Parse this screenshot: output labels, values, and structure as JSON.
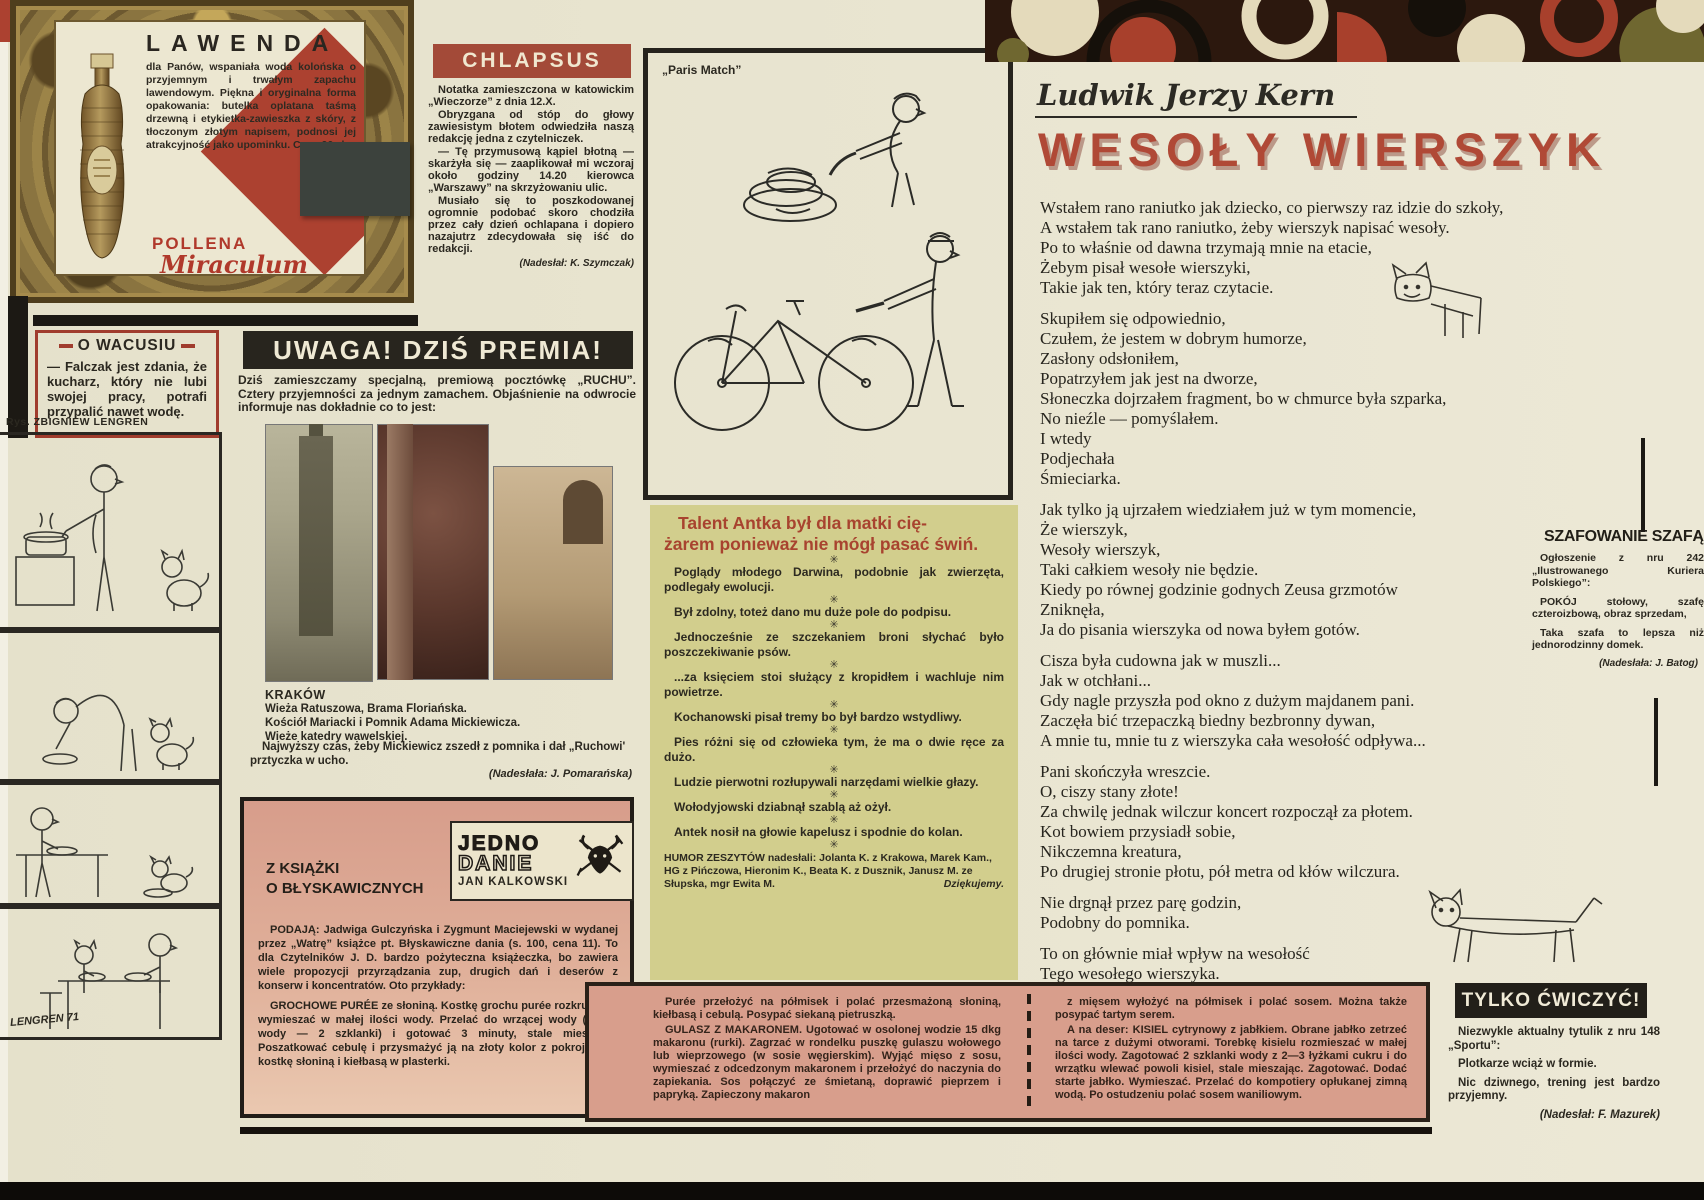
{
  "lawenda": {
    "title": "LAWENDA",
    "body": "dla Panów, wspaniała woda kolońska o przyjemnym i trwałym zapachu lawendowym. Piękna i oryginalna forma opakowania: butelka oplatana taśmą drzewną i etykietka-zawieszka z skóry, z tłoczonym złotym napisem, podnosi jej atrakcyjność jako upominku. Cena 90 zł.",
    "code": "K—30",
    "brand": "POLLENA",
    "brand_script": "Miraculum"
  },
  "chlapsus": {
    "title": "CHLAPSUS",
    "paragraphs": [
      "Notatka zamieszczona w katowickim „Wieczorze” z dnia 12.X.",
      "Obryzgana od stóp do głowy zawiesistym błotem odwiedziła naszą redakcję jedna z czytelniczek.",
      "— Tę przymusową kąpiel błotną — skarżyła się — zaaplikował mi wczoraj około godziny 14.20 kierowca „Warszawy” na skrzyżowaniu ulic.",
      "Musiało się to poszkodowanej ogromnie podobać skoro chodziła przez cały dzień ochlapana i dopiero nazajutrz zdecydowała się iść do redakcji."
    ],
    "credit": "(Nadesłał: K. Szymczak)"
  },
  "wacusiu": {
    "title": "O WACUSIU",
    "text": "— Falczak jest zdania, że kucharz, który nie lubi swojej pracy, potrafi przypalić nawet wodę."
  },
  "lengren": {
    "caption": "Rys. ZBIGNIEW LENGREN",
    "signature": "LENGREN 71"
  },
  "uwaga": {
    "title": "UWAGA! DZIŚ PREMIA!",
    "intro": "Dziś zamieszczamy specjalną, premiową pocztówkę „RUCHU”. Cztery przyjemności za jednym zamachem. Objaśnienie na odwrocie informuje nas dokładnie co to jest:",
    "city": "KRAKÓW",
    "caption_lines": [
      "Wieża Ratuszowa, Brama Floriańska.",
      "Kościół Mariacki i Pomnik Adama Mickiewicza.",
      "Wieże katedry wawelskiej."
    ],
    "note": "Najwyższy czas, żeby Mickiewicz zszedł z pomnika i dał „Ruchowi' prztyczka w ucho.",
    "credit": "(Nadesłała: J. Pomarańska)"
  },
  "paris_match": {
    "label": "„Paris Match”"
  },
  "talent": {
    "title": "Talent Antka był dla matki cię-\nżarem ponieważ nie mógł pasać świń.",
    "separator": "✳",
    "items": [
      "Poglądy młodego Darwina, podobnie jak zwierzęta, podlegały ewolucji.",
      "Był zdolny, toteż dano mu duże pole do podpisu.",
      "Jednocześnie ze szczekaniem broni słychać było poszczekiwanie psów.",
      "...za księciem stoi służący z kropidłem i wachluje nim powietrze.",
      "Kochanowski pisał tremy bo był bardzo wstydliwy.",
      "Pies różni się od człowieka tym, że ma o dwie ręce za dużo.",
      "Ludzie pierwotni rozłupywali narzędami wielkie głazy.",
      "Wołodyjowski dziabnął szablą aż ożył.",
      "Antek nosił na głowie kapelusz i spodnie do kolan."
    ],
    "footer": "HUMOR ZESZYTÓW nadesłali: Jolanta K. z Krakowa, Marek Kam., HG z Pińczowa, Hieronim K., Beata K. z Dusznik, Janusz M. ze Słupska, mgr Ewita M.",
    "thanks": "Dziękujemy."
  },
  "kern": {
    "author": "Ludwik Jerzy Kern",
    "title": "WESOŁY WIERSZYK",
    "stanzas": [
      [
        "Wstałem rano raniutko jak dziecko, co pierwszy raz idzie do szkoły,",
        "A wstałem tak rano raniutko, żeby wierszyk napisać wesoły.",
        "Po to właśnie od dawna trzymają mnie na etacie,",
        "Żebym pisał wesołe wierszyki,",
        "Takie jak ten, który teraz czytacie."
      ],
      [
        "Skupiłem się odpowiednio,",
        "Czułem, że jestem w dobrym humorze,",
        "Zasłony odsłoniłem,",
        "Popatrzyłem jak jest na dworze,",
        "Słoneczka dojrzałem fragment, bo w chmurce była szparka,",
        "No nieźle — pomyślałem.",
        "I wtedy",
        "Podjechała",
        "Śmieciarka."
      ],
      [
        "Jak tylko ją ujrzałem wiedziałem już w tym momencie,",
        "Że wierszyk,",
        "Wesoły wierszyk,",
        "Taki całkiem wesoły nie będzie.",
        "Kiedy po równej godzinie godnych Zeusa grzmotów",
        "Zniknęła,",
        "Ja do pisania wierszyka od nowa byłem gotów."
      ],
      [
        "Cisza była cudowna jak w muszli...",
        "Jak w otchłani...",
        "Gdy nagle przyszła pod okno z dużym majdanem pani.",
        "Zaczęła bić trzepaczką biedny bezbronny dywan,",
        "A mnie tu, mnie tu z wierszyka cała wesołość odpływa..."
      ],
      [
        "Pani skończyła wreszcie.",
        "O, ciszy stany złote!",
        "Za chwilę jednak wilczur koncert rozpoczął za płotem.",
        "Kot bowiem przysiadł sobie,",
        "Nikczemna kreatura,",
        "Po drugiej stronie płotu, pół metra od kłów wilczura."
      ],
      [
        "Nie drgnął przez parę godzin,",
        "Podobny do pomnika."
      ],
      [
        "To on głównie miał wpływ na wesołość",
        "Tego wesołego wierszyka."
      ]
    ]
  },
  "szafowanie": {
    "title": "SZAFOWANIE SZAFĄ",
    "p1": "Ogłoszenie z nru 242 „Ilustrowanego Kuriera Polskiego”:",
    "p2": "POKÓJ stołowy, szafę czteroizbową, obraz sprzedam,",
    "p3": "Taka szafa to lepsza niż jednorodzinny domek.",
    "credit": "(Nadesłała: J. Batog)"
  },
  "tylko": {
    "title": "TYLKO ĆWICZYĆ!",
    "p1": "Niezwykle aktualny tytulik z nru 148 „Sportu”:",
    "p2": "Plotkarze wciąż w formie.",
    "p3": "Nic dziwnego, trening jest bardzo przyjemny.",
    "credit": "(Nadesłał: F. Mazurek)"
  },
  "jedno": {
    "section_title": "Z KSIĄŻKI\nO BŁYSKAWICZNYCH",
    "logo_line1": "JEDNO",
    "logo_line2": "DANIE",
    "logo_author": "JAN KALKOWSKI",
    "paragraphs": [
      {
        "lead": "PODAJĄ: ",
        "text": "Jadwiga Gulczyńska i Zygmunt Maciejewski w wydanej przez „Watrę” książce pt. Błyskawiczne dania (s. 100, cena 11). To dla Czytelników J. D. bardzo pożyteczna książeczka, bo zawiera wiele propozycji przyrządzania zup, drugich dań i deserów z konserw i koncentratów. Oto przykłady:"
      },
      {
        "lead": "GROCHOWE PURÉE ",
        "text": "ze słoniną. Kostkę grochu purée rozkruszyć i wymieszać w małej ilości wody. Przelać do wrzącej wody (razem wody — 2 szklanki) i gotować 3 minuty, stale mieszając. Poszatkować cebulę i przysmażyć ją na złoty kolor z pokrojoną w kostkę słoniną i kiełbasą w plasterki."
      }
    ]
  },
  "recipes": {
    "left": [
      {
        "lead": "",
        "text": "Purée przełożyć na półmisek i polać przesmażoną słoniną, kiełbasą i cebulą. Posypać siekaną pietruszką."
      },
      {
        "lead": "GULASZ Z MAKARONEM. ",
        "text": "Ugotować w osolonej wodzie 15 dkg makaronu (rurki). Zagrzać w rondelku puszkę gulaszu wołowego lub wieprzowego (w sosie węgierskim). Wyjąć mięso z sosu, wymieszać z odcedzonym makaronem i przełożyć do naczynia do zapiekania. Sos połączyć ze śmietaną, doprawić pieprzem i papryką. Zapieczony makaron"
      }
    ],
    "right": [
      {
        "lead": "",
        "text": "z mięsem wyłożyć na półmisek i polać sosem. Można także posypać tartym serem."
      },
      {
        "lead": "A na deser: KISIEL cytrynowy z jabłkiem. ",
        "text": "Obrane jabłko zetrzeć na tarce z dużymi otworami. Torebkę kisielu rozmieszać w małej ilości wody. Zagotować 2 szklanki wody z 2—3 łyżkami cukru i do wrzątku wlewać powoli kisiel, stale mieszając. Zagotować. Dodać starte jabłko. Wymieszać. Przelać do kompotiery opłukanej zimną wodą. Po ostudzeniu polać sosem waniliowym."
      }
    ]
  },
  "colors": {
    "accent_red": "#a8432f",
    "humor_bg": "#d2ce8d",
    "pink_bg": "#d89e8c",
    "banner_black": "#28251e"
  }
}
